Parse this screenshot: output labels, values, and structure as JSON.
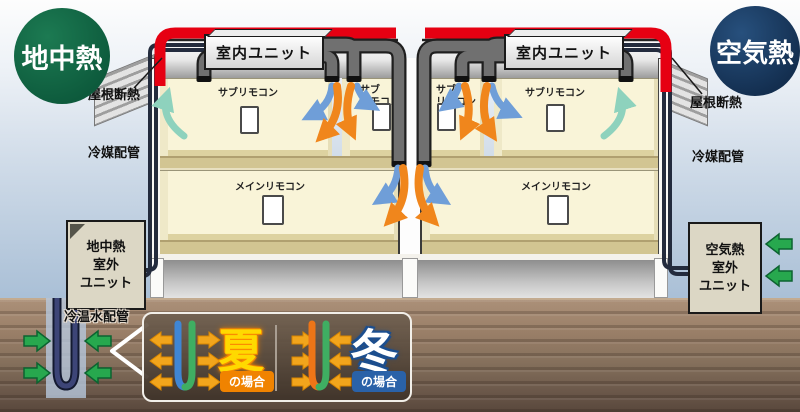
{
  "badges": {
    "geothermal": "地中熱",
    "air": "空気熱"
  },
  "building": {
    "indoor_unit": "室内ユニット",
    "sub_remote": "サブリモコン",
    "sub_remote_line1": "サブ",
    "sub_remote_line2": "リモコン",
    "main_remote": "メインリモコン",
    "roof_insulation": "屋根断熱",
    "refrigerant_piping": "冷媒配管"
  },
  "outdoor_units": {
    "geothermal_lines": [
      "地中熱",
      "室外",
      "ユニット"
    ],
    "air_lines": [
      "空気熱",
      "室外",
      "ユニット"
    ],
    "water_piping": "冷温水配管"
  },
  "legend": {
    "summer_char": "夏",
    "summer_case": "の場合",
    "winter_char": "冬",
    "winter_case": "の場合"
  },
  "colors": {
    "roof_insulation_red": "#e60012",
    "badge_green": "#0d5a3c",
    "badge_navy": "#1a3a63",
    "warm_arrow_orange": "#f0861c",
    "cool_arrow_blue": "#6f9ed8",
    "return_arrow_teal": "#8ed2bd",
    "ground_arrow_green": "#27a84e",
    "heat_arrow_gold": "#f2a51c",
    "summer_yellow": "#ffd900",
    "winter_blue": "#2a62a8"
  }
}
